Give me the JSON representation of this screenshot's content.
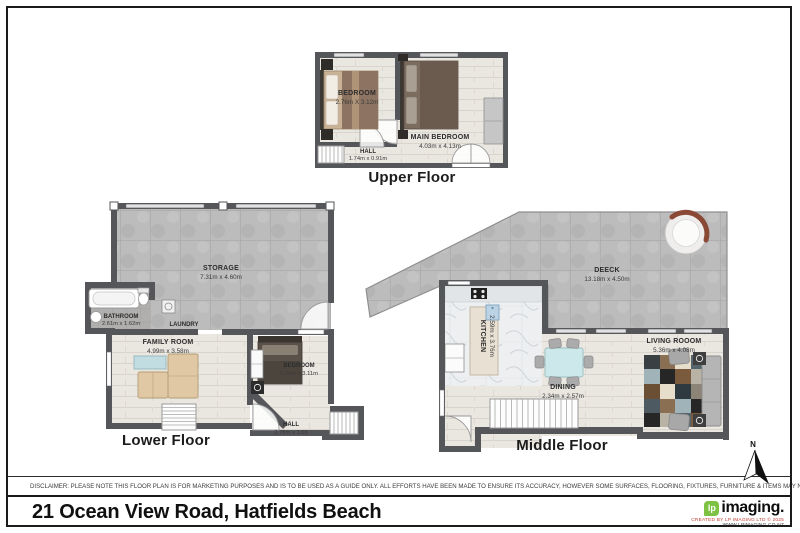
{
  "page": {
    "width": 800,
    "height": 533
  },
  "plans": {
    "upper": {
      "title": "Upper Floor",
      "rooms": {
        "bedroom": {
          "name": "BEDROOM",
          "dims": "2.76m X 3.12m"
        },
        "main_bedroom": {
          "name": "MAIN BEDROOM",
          "dims": "4.03m x 4.13m"
        },
        "hall": {
          "name": "HALL",
          "dims": "1.74m x 0.91m"
        }
      }
    },
    "lower": {
      "title": "Lower Floor",
      "rooms": {
        "storage": {
          "name": "STORAGE",
          "dims": "7.31m x 4.60m"
        },
        "bathroom": {
          "name": "BATHROOM",
          "dims": "2.61m x 1.62m"
        },
        "laundry": {
          "name": "LAUNDRY"
        },
        "family_room": {
          "name": "FAMILY ROOM",
          "dims": "4.99m x 3.58m"
        },
        "bedroom": {
          "name": "BEDROOM",
          "dims": "2.90m x 3.11m"
        },
        "hall": {
          "name": "HALL",
          "dims": "2.78m x 1.65"
        }
      }
    },
    "middle": {
      "title": "Middle Floor",
      "rooms": {
        "deck": {
          "name": "DEECK",
          "dims": "13.18m x 4.50m"
        },
        "kitchen": {
          "name": "KITCHEN",
          "dims": "2.59m x 3.76m"
        },
        "dining": {
          "name": "DINING",
          "dims": "2.34m x 2.57m"
        },
        "living_room": {
          "name": "LIVING ROOOM",
          "dims": "5.36m x 4.08m"
        }
      }
    }
  },
  "compass": {
    "label": "N"
  },
  "footer": {
    "disclaimer": "DISCLAIMER: PLEASE NOTE THIS FLOOR PLAN IS FOR MARKETING PURPOSES AND IS TO BE USED AS A GUIDE ONLY. ALL EFFORTS HAVE BEEN MADE TO ENSURE ITS ACCURACY, HOWEVER SOME SURFACES, FLOORING, FIXTURES, FURNITURE & ITEMS MAY NOT REPRESENT THE ACTUAL PROPERTY.",
    "address": "21 Ocean View Road, Hatfields Beach",
    "logo": {
      "glyph": "lp",
      "name": "imaging.",
      "line1": "CREATED BY LP IMAGING LTD © 2025",
      "line2": "WWW.LPIMAGING.CO.NZ"
    }
  },
  "colors": {
    "wall": "#55565a",
    "logo_green": "#7dc242",
    "logo_red": "#c23b2e",
    "title_text": "#101010"
  }
}
